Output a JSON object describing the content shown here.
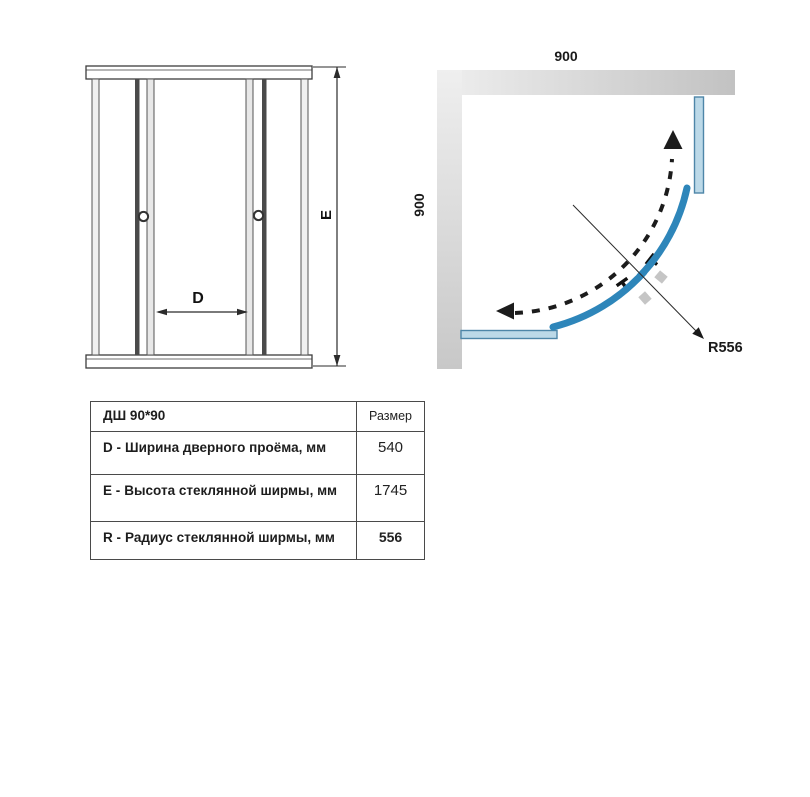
{
  "front_view": {
    "door_opening_label": "D",
    "height_label": "E"
  },
  "top_view": {
    "width_dim": "900",
    "depth_dim": "900",
    "radius_label": "R556"
  },
  "spec_table": {
    "header": {
      "model": "ДШ 90*90",
      "size_col": "Размер"
    },
    "rows": [
      {
        "key": "D -",
        "label": "Ширина дверного проёма, мм",
        "value": "540"
      },
      {
        "key": "E -",
        "label": "Высота стеклянной ширмы, мм",
        "value": "1745"
      },
      {
        "key": "R -",
        "label": "Радиус стеклянной ширмы, мм",
        "value": "556"
      }
    ]
  },
  "colors": {
    "glass_blue": "#2e86ba",
    "panel_fill": "#bcd9e8",
    "panel_stroke": "#4e86a8",
    "wall_gray_light": "#ececec",
    "wall_gray_dark": "#c4c4c4",
    "line_dark": "#3d3d3d"
  }
}
